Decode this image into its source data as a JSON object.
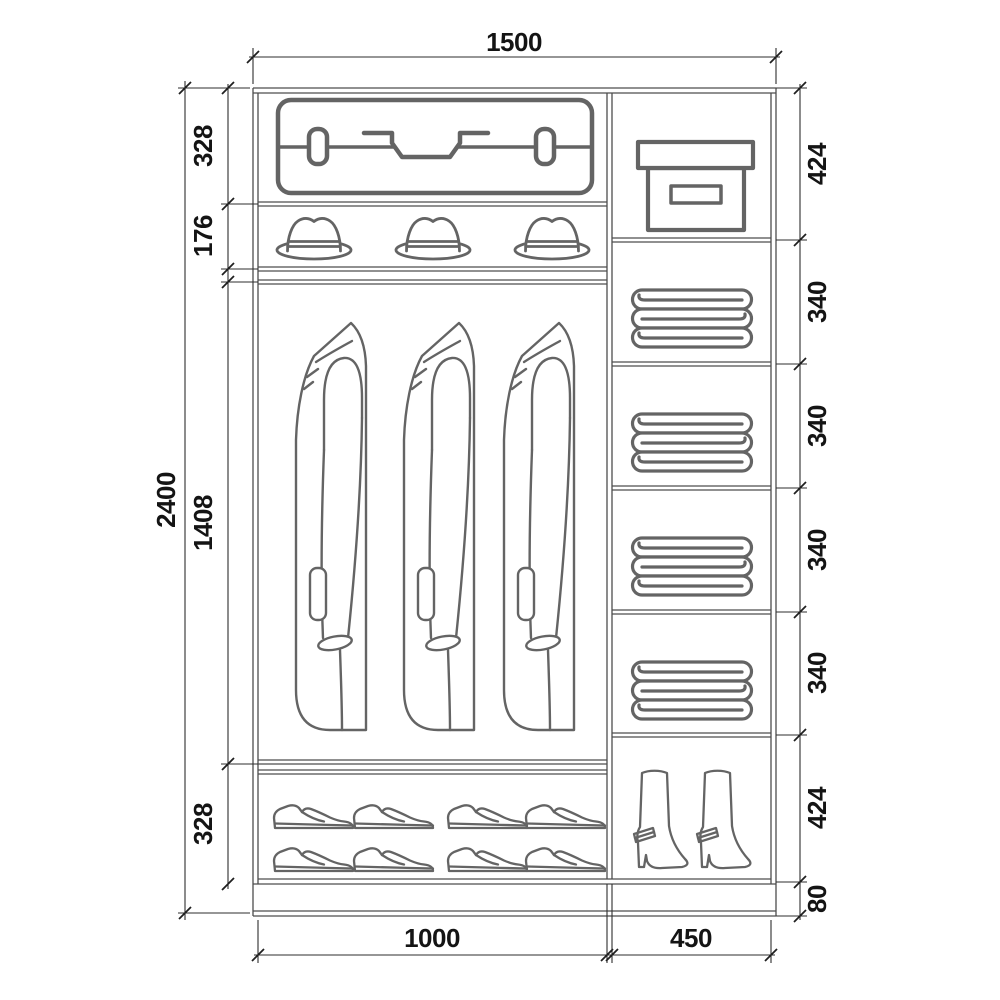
{
  "diagram": {
    "kind": "wardrobe-interior-elevation",
    "units": "mm"
  },
  "dimensions": {
    "overall_width": "1500",
    "overall_height": "2400",
    "left_bay_width": "1000",
    "right_bay_width": "450",
    "left_sections": [
      "328",
      "176",
      "1408",
      "328"
    ],
    "right_sections": [
      "424",
      "340",
      "340",
      "340",
      "340",
      "424",
      "80"
    ]
  },
  "contents": {
    "left_bay": [
      "suitcase",
      "fedora-hat x3",
      "hanging-coat x3",
      "dress-shoe x8"
    ],
    "right_bay": [
      "storage-box",
      "folded-linen x4",
      "high-heel-boot x2"
    ]
  },
  "colors": {
    "background": "#ffffff",
    "structure_line": "#4d4d4d",
    "icon_stroke": "#646464",
    "dimension_text": "#141414"
  }
}
